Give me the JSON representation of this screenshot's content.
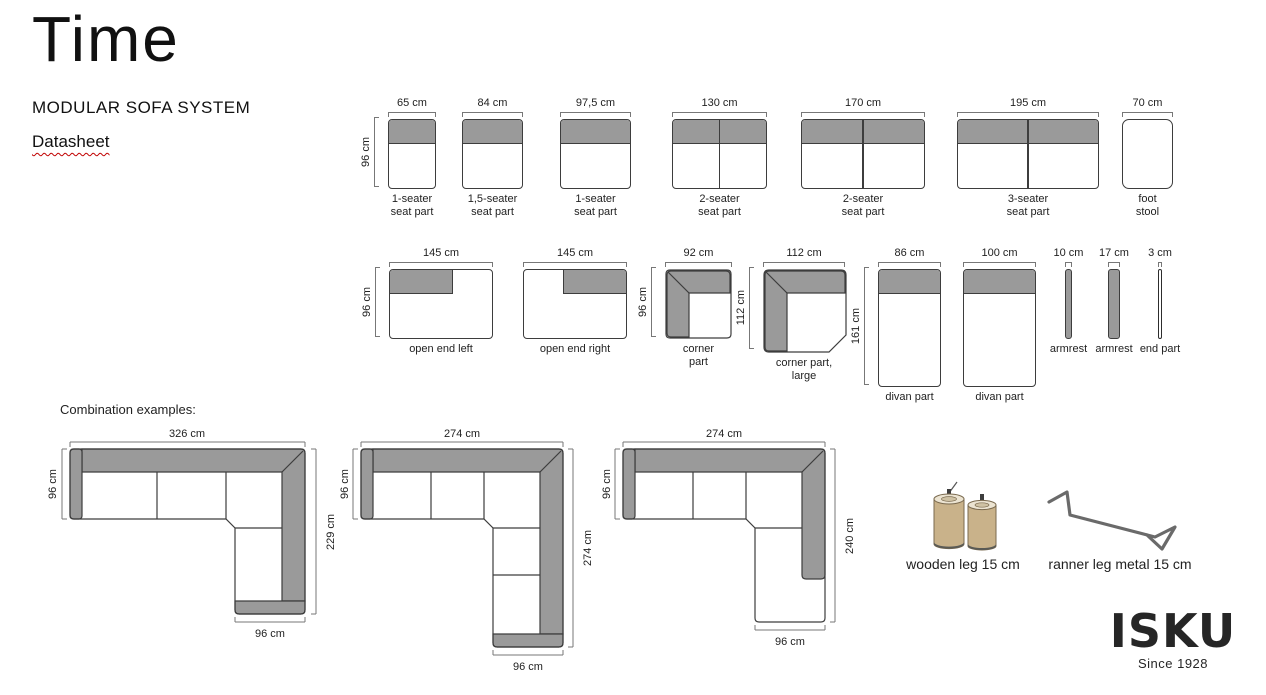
{
  "header": {
    "title": "Time",
    "subtitle": "MODULAR SOFA SYSTEM",
    "doc_label": "Datasheet"
  },
  "colors": {
    "module_gray": "#9a9a9a",
    "outline": "#3d3d3d",
    "dimension_line": "#777777",
    "underline_red": "#c00000",
    "wood": "#c9b28a"
  },
  "modules_row1": [
    {
      "width_label": "65 cm",
      "height_label": "96 cm",
      "label": "1-seater\nseat part"
    },
    {
      "width_label": "84 cm",
      "label": "1,5-seater\nseat part"
    },
    {
      "width_label": "97,5 cm",
      "label": "1-seater\nseat part"
    },
    {
      "width_label": "130 cm",
      "label": "2-seater\nseat part"
    },
    {
      "width_label": "170 cm",
      "label": "2-seater\nseat part"
    },
    {
      "width_label": "195 cm",
      "label": "3-seater\nseat part"
    },
    {
      "width_label": "70 cm",
      "label": "foot\nstool"
    }
  ],
  "modules_row2": [
    {
      "width_label": "145 cm",
      "height_label": "96 cm",
      "label": "open end left"
    },
    {
      "width_label": "145 cm",
      "label": "open end right"
    },
    {
      "width_label": "92 cm",
      "height_label": "96 cm",
      "label": "corner\npart"
    },
    {
      "width_label": "112 cm",
      "height_label": "112 cm",
      "label": "corner part,\nlarge"
    },
    {
      "width_label": "86 cm",
      "height_label": "161 cm",
      "label": "divan part"
    },
    {
      "width_label": "100 cm",
      "label": "divan part"
    },
    {
      "width_label": "10 cm",
      "label": "armrest"
    },
    {
      "width_label": "17 cm",
      "label": "armrest"
    },
    {
      "width_label": "3 cm",
      "label": "end part"
    }
  ],
  "combinations": {
    "heading": "Combination examples:",
    "items": [
      {
        "top": "326 cm",
        "left": "96 cm",
        "right": "229 cm",
        "bottom": "96 cm"
      },
      {
        "top": "274 cm",
        "left": "96 cm",
        "right": "274 cm",
        "bottom": "96 cm"
      },
      {
        "top": "274 cm",
        "left": "96 cm",
        "right": "240 cm",
        "bottom": "96 cm"
      }
    ]
  },
  "legs": {
    "wooden": "wooden leg 15 cm",
    "runner": "ranner leg metal 15 cm"
  },
  "logo": {
    "brand": "ISKU",
    "tagline": "Since 1928"
  }
}
